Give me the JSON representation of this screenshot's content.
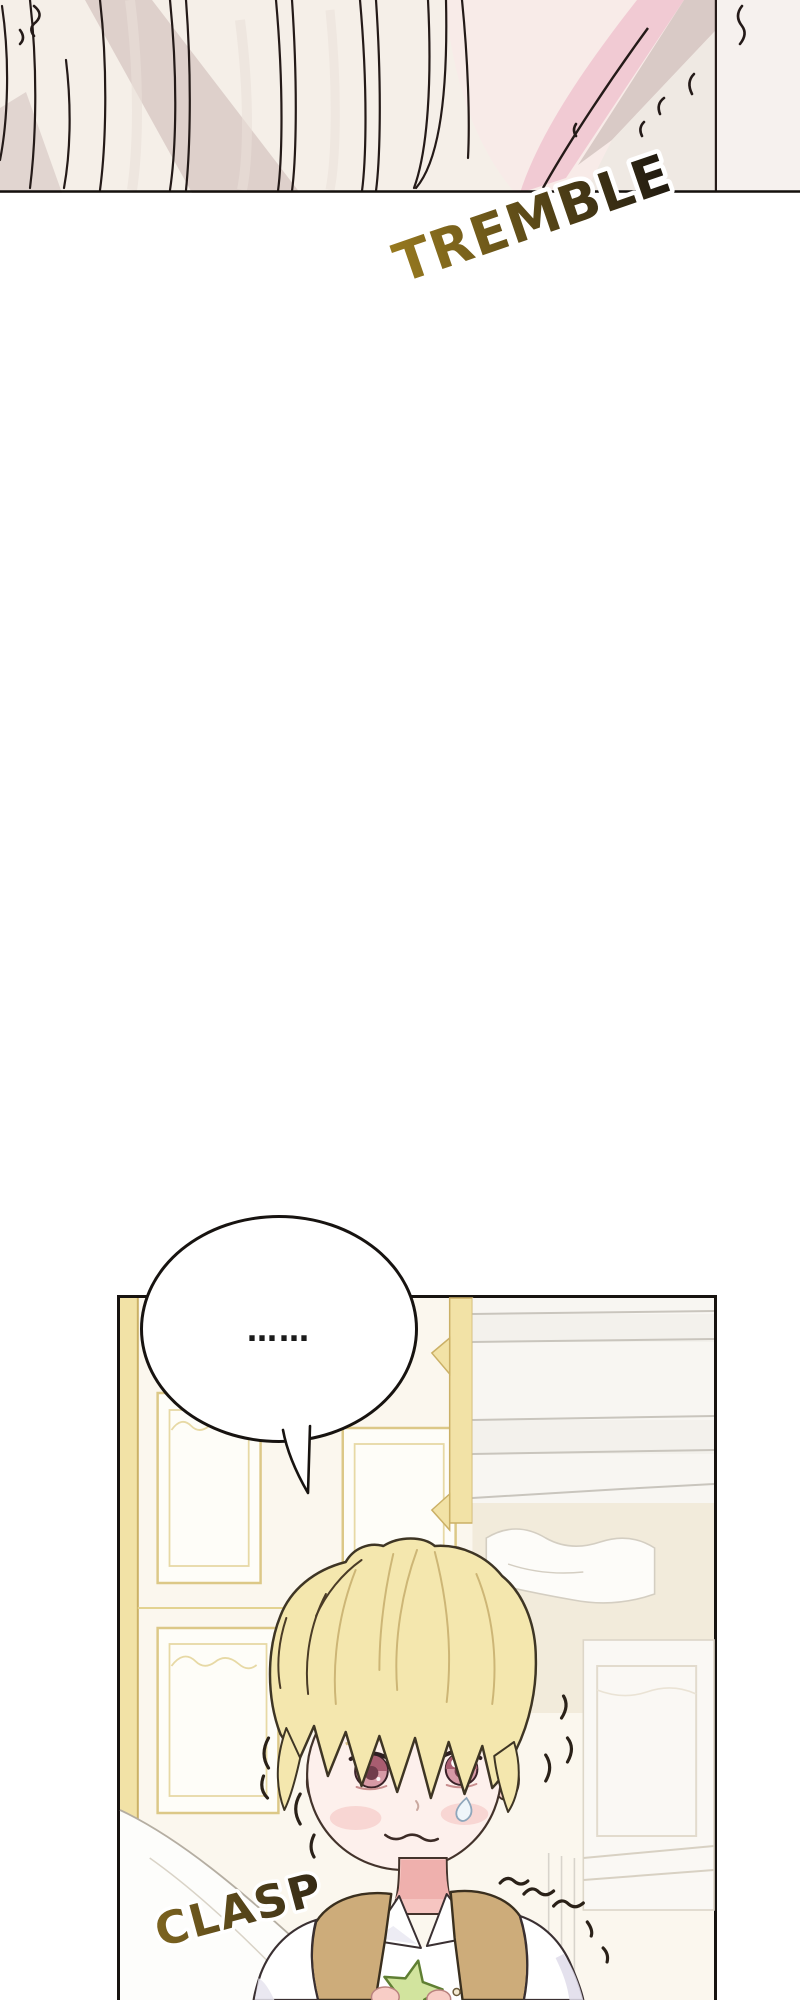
{
  "page": {
    "type": "manhwa-webtoon-page",
    "background": "#ffffff",
    "width": 800,
    "height": 2000
  },
  "panels": [
    {
      "id": "panel-1",
      "description": "close-up of pale cream hair strands trembling against a pink background"
    },
    {
      "id": "panel-2",
      "description": "blonde boy with wide pink eyes clasping a small green star in a gold-paneled bedroom"
    }
  ],
  "speech_bubble": {
    "text": "……"
  },
  "sfx": {
    "tremble": {
      "text": "TREMBLE",
      "color_from": "#97791f",
      "color_to": "#1f1910"
    },
    "clasp": {
      "text": "CLASP",
      "color_from": "#7d641f",
      "color_to": "#332916"
    }
  },
  "palette": {
    "panel_bg_pink": "#f8ebe8",
    "hair_cream": "#f5efe8",
    "shadow_taupe": "#d9cac6",
    "ribbon_pink": "#f1cad3",
    "room_wall": "#fbf7ee",
    "gold_fill": "#f2e2a6",
    "gold_trim": "#cbb066",
    "boy_hair": "#f4e7ae",
    "skin": "#fdf0ec",
    "neck_pink": "#f6c5c1",
    "vest_tan": "#cdac7a",
    "eye_pink": "#d295a1",
    "star_green": "#d2e49e",
    "ink": "#1c1714"
  }
}
